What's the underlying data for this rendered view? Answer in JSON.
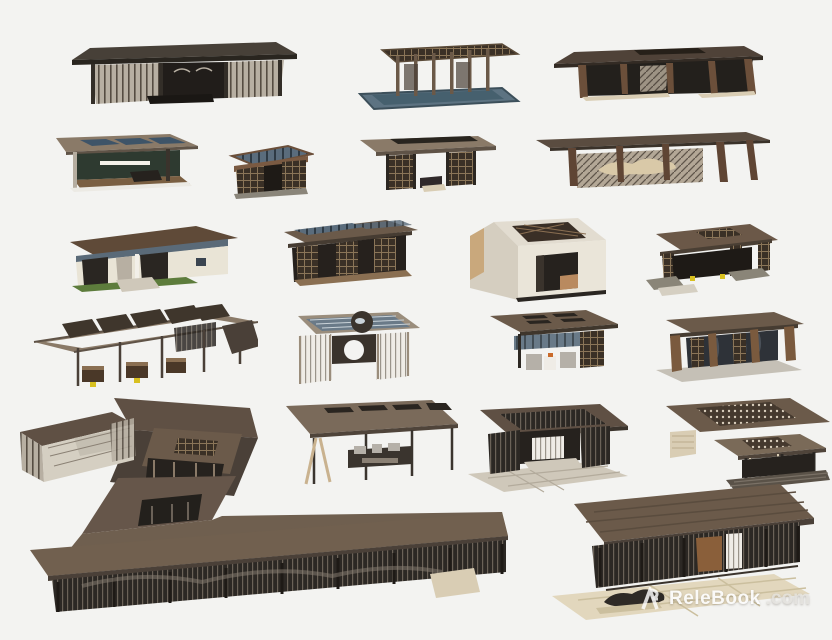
{
  "page": {
    "background": "#f3f3f1",
    "description": "Catalog sheet of 21 modern Chinese-style pavilion 3D models arranged in rows on a white backdrop"
  },
  "watermark": {
    "logo_icon": "relebook-ribbon-R",
    "name": "ReleBook",
    "suffix": ".com"
  },
  "palette": {
    "roof_brown": "#6b5a4a",
    "roof_taupe": "#8a7a68",
    "roof_dark": "#474038",
    "fascia_dark": "#2c2722",
    "timber": "#7a5a3e",
    "glass_beige": "#b7afa2",
    "mesh_dark": "#2c2824",
    "pool_blue": "#5d7382",
    "sky_glass": "#4a5f72",
    "cream_wall": "#e9e4d6",
    "grass": "#5d7c3c",
    "stone": "#cfc8ba",
    "paving_beige": "#e2d7bd",
    "accent_yellow": "#d8c020",
    "watermark_white": "#ffffff"
  },
  "models": [
    {
      "label": "flat-roof glass pavilion"
    },
    {
      "label": "open pergola over reflecting pool"
    },
    {
      "label": "dark timber pavilion with roof opening"
    },
    {
      "label": "skylight lounge pavilion"
    },
    {
      "label": "ornate lattice garden pavilion"
    },
    {
      "label": "twin-screen tea pavilion"
    },
    {
      "label": "long canopy with landscape screen"
    },
    {
      "label": "garden house with lawn"
    },
    {
      "label": "glass-slat roof veranda"
    },
    {
      "label": "marble cube pavilion with lattice skylight"
    },
    {
      "label": "courtyard pavilion with stone benches"
    },
    {
      "label": "slatted pergola walkway"
    },
    {
      "label": "glass-top fire-pit pergola"
    },
    {
      "label": "awning pavilion with seating"
    },
    {
      "label": "timber lattice pavilion on plinth"
    },
    {
      "label": "courtyard cluster with lattice enclosure"
    },
    {
      "label": "cantilevered bar canopy"
    },
    {
      "label": "slat-roof pavilion on stone terrace"
    },
    {
      "label": "double-roof perforated pavilion"
    },
    {
      "label": "L-shaped mesh corridor"
    },
    {
      "label": "mesh-walled pavilion with rock garden"
    }
  ]
}
